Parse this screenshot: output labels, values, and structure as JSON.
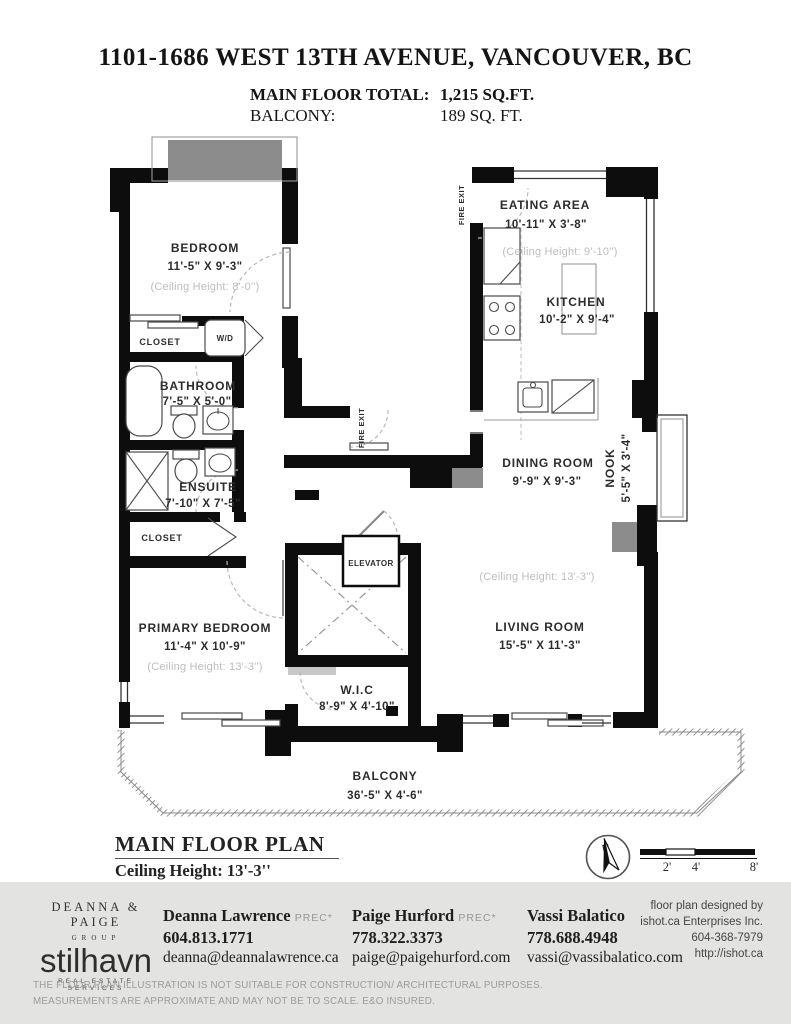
{
  "header": {
    "title": "1101-1686 WEST 13TH AVENUE, VANCOUVER, BC",
    "total_label": "MAIN FLOOR TOTAL:",
    "total_value": "1,215 SQ.FT.",
    "balcony_label": "BALCONY:",
    "balcony_value": "189 SQ. FT."
  },
  "plan": {
    "rooms": {
      "bedroom": {
        "name": "BEDROOM",
        "dims": "11'-5\" X 9'-3\"",
        "ceiling": "(Ceiling Height: 8'-0'')"
      },
      "bathroom": {
        "name": "BATHROOM",
        "dims": "7'-5\" X 5'-0\""
      },
      "ensuite": {
        "name": "ENSUITE",
        "dims": "7'-10\" X 7'-5\""
      },
      "primary_bedroom": {
        "name": "PRIMARY BEDROOM",
        "dims": "11'-4\" X 10'-9\"",
        "ceiling": "(Ceiling Height: 13'-3'')"
      },
      "wic": {
        "name": "W.I.C",
        "dims": "8'-9\" X 4'-10\""
      },
      "eating_area": {
        "name": "EATING AREA",
        "dims": "10'-11\" X 3'-8\"",
        "ceiling": "(Ceiling Height: 9'-10'')"
      },
      "kitchen": {
        "name": "KITCHEN",
        "dims": "10'-2\" X 9'-4\""
      },
      "dining_room": {
        "name": "DINING ROOM",
        "dims": "9'-9\" X 9'-3\""
      },
      "nook": {
        "name": "NOOK",
        "dims": "5'-5\" X 3'-4\""
      },
      "living_room": {
        "name": "LIVING ROOM",
        "dims": "15'-5\" X 11'-3\"",
        "ceiling": "(Ceiling Height: 13'-3'')"
      },
      "balcony": {
        "name": "BALCONY",
        "dims": "36'-5\" X 4'-6\""
      }
    },
    "labels": {
      "fire_exit": "FIRE EXIT",
      "elevator": "ELEVATOR",
      "wd": "W/D",
      "closet": "CLOSET"
    },
    "caption_title": "MAIN FLOOR PLAN",
    "caption_subtitle": "Ceiling Height: 13'-3''",
    "compass_n": "N",
    "scale": {
      "t2": "2'",
      "t4": "4'",
      "t8": "8'"
    }
  },
  "footer": {
    "brand": {
      "line1": "DEANNA & PAIGE",
      "line2": "GROUP",
      "wordmark": "stilhavn",
      "tagline": "REAL ESTATE SERVICES"
    },
    "agents": [
      {
        "name": "Deanna Lawrence",
        "designation": "PREC*",
        "phone": "604.813.1771",
        "email": "deanna@deannalawrence.ca"
      },
      {
        "name": "Paige Hurford",
        "designation": "PREC*",
        "phone": "778.322.3373",
        "email": "paige@paigehurford.com"
      },
      {
        "name": "Vassi Balatico",
        "designation": "",
        "phone": "778.688.4948",
        "email": "vassi@vassibalatico.com"
      }
    ],
    "designer": {
      "line1": "floor plan designed by",
      "line2": "ishot.ca Enterprises Inc.",
      "line3": "604-368-7979",
      "line4": "http://ishot.ca"
    },
    "disclaimer_line1": "THE FLOOR PLAN ILLUSTRATION IS NOT SUITABLE FOR CONSTRUCTION/ ARCHITECTURAL PURPOSES.",
    "disclaimer_line2": "MEASUREMENTS ARE APPROXIMATE AND MAY NOT BE TO SCALE. E&O INSURED."
  }
}
